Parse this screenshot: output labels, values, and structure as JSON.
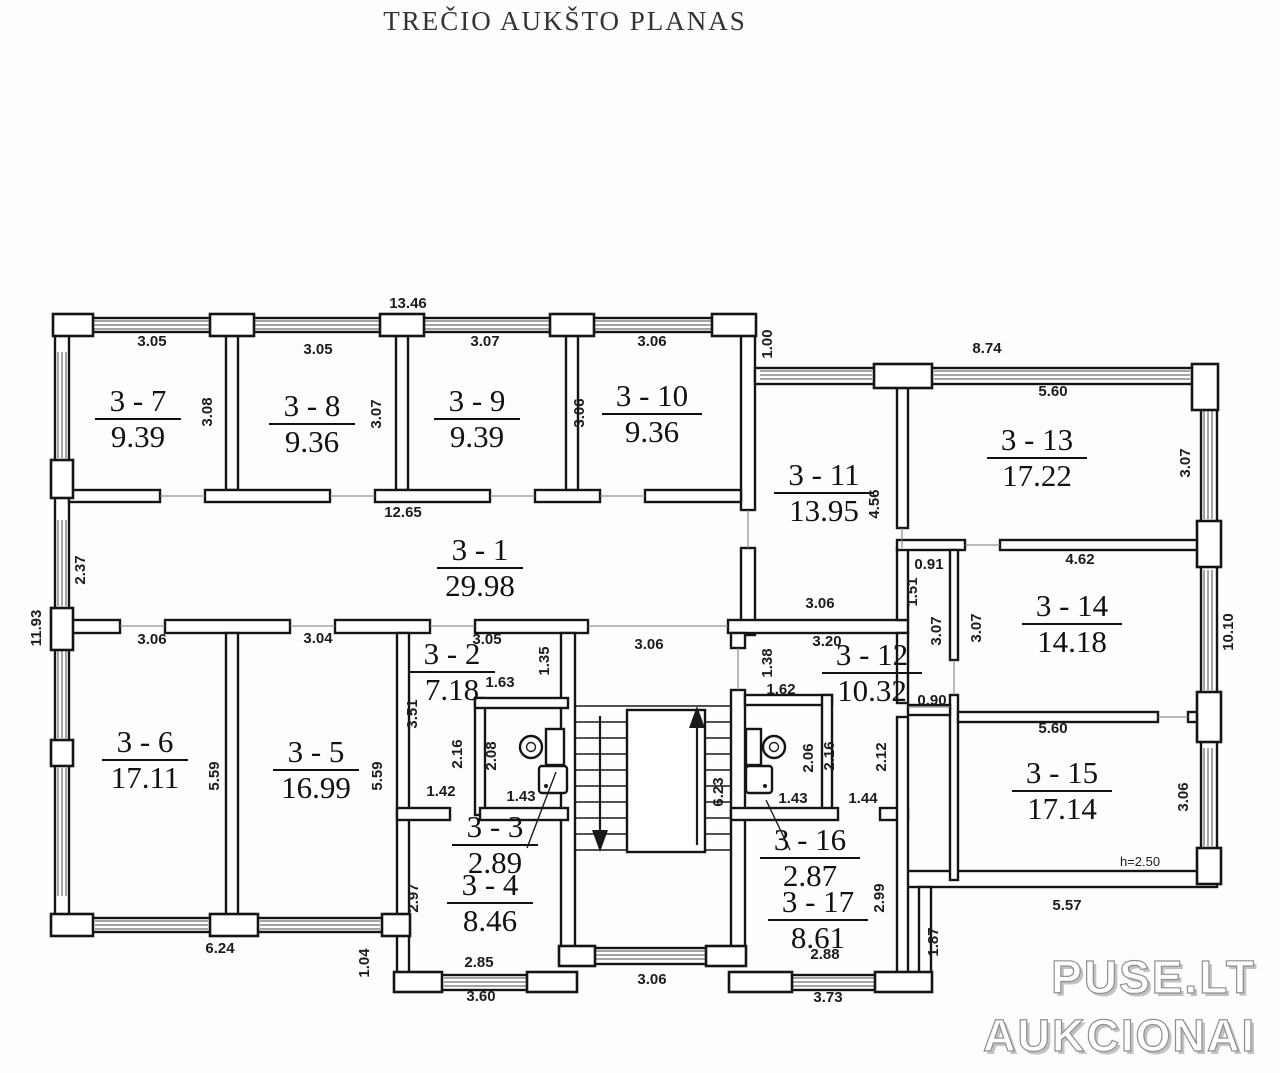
{
  "title": "TREČIO AUKŠTO PLANAS",
  "watermark": {
    "line1": "PUSE.LT",
    "line2": "AUKCIONAI"
  },
  "rooms": [
    {
      "id": "3 - 7",
      "area": "9.39",
      "x": 138,
      "y": 419
    },
    {
      "id": "3 - 8",
      "area": "9.36",
      "x": 312,
      "y": 424
    },
    {
      "id": "3 - 9",
      "area": "9.39",
      "x": 477,
      "y": 419
    },
    {
      "id": "3 - 10",
      "area": "9.36",
      "x": 652,
      "y": 414
    },
    {
      "id": "3 - 1",
      "area": "29.98",
      "x": 480,
      "y": 568
    },
    {
      "id": "3 - 2",
      "area": "7.18",
      "x": 452,
      "y": 672
    },
    {
      "id": "3 - 3",
      "area": "2.89",
      "x": 495,
      "y": 845
    },
    {
      "id": "3 - 4",
      "area": "8.46",
      "x": 490,
      "y": 903
    },
    {
      "id": "3 - 5",
      "area": "16.99",
      "x": 316,
      "y": 770
    },
    {
      "id": "3 - 6",
      "area": "17.11",
      "x": 145,
      "y": 760
    },
    {
      "id": "3 - 11",
      "area": "13.95",
      "x": 824,
      "y": 493
    },
    {
      "id": "3 - 12",
      "area": "10.32",
      "x": 872,
      "y": 673
    },
    {
      "id": "3 - 13",
      "area": "17.22",
      "x": 1037,
      "y": 458
    },
    {
      "id": "3 - 14",
      "area": "14.18",
      "x": 1072,
      "y": 624
    },
    {
      "id": "3 - 15",
      "area": "17.14",
      "x": 1062,
      "y": 791
    },
    {
      "id": "3 - 16",
      "area": "2.87",
      "x": 810,
      "y": 858
    },
    {
      "id": "3 - 17",
      "area": "8.61",
      "x": 818,
      "y": 920
    }
  ],
  "dims": [
    {
      "t": "13.46",
      "x": 408,
      "y": 308
    },
    {
      "t": "3.05",
      "x": 152,
      "y": 346
    },
    {
      "t": "3.05",
      "x": 318,
      "y": 354
    },
    {
      "t": "3.07",
      "x": 485,
      "y": 346
    },
    {
      "t": "3.06",
      "x": 652,
      "y": 346
    },
    {
      "t": "1.00",
      "x": 772,
      "y": 344,
      "v": 1
    },
    {
      "t": "8.74",
      "x": 987,
      "y": 353
    },
    {
      "t": "5.60",
      "x": 1053,
      "y": 396
    },
    {
      "t": "3.08",
      "x": 212,
      "y": 412,
      "v": 1
    },
    {
      "t": "3.07",
      "x": 381,
      "y": 414,
      "v": 1
    },
    {
      "t": "3.06",
      "x": 584,
      "y": 413,
      "v": 1
    },
    {
      "t": "3.07",
      "x": 1190,
      "y": 463,
      "v": 1
    },
    {
      "t": "12.65",
      "x": 403,
      "y": 517
    },
    {
      "t": "2.37",
      "x": 85,
      "y": 570,
      "v": 1
    },
    {
      "t": "11.93",
      "x": 41,
      "y": 628,
      "v": 1
    },
    {
      "t": "4.56",
      "x": 879,
      "y": 504,
      "v": 1
    },
    {
      "t": "3.06",
      "x": 820,
      "y": 608
    },
    {
      "t": "0.91",
      "x": 929,
      "y": 569
    },
    {
      "t": "1.51",
      "x": 917,
      "y": 592,
      "v": 1
    },
    {
      "t": "4.62",
      "x": 1080,
      "y": 564
    },
    {
      "t": "3.07",
      "x": 941,
      "y": 631,
      "v": 1
    },
    {
      "t": "3.07",
      "x": 981,
      "y": 628,
      "v": 1
    },
    {
      "t": "10.10",
      "x": 1233,
      "y": 632,
      "v": 1
    },
    {
      "t": "3.06",
      "x": 152,
      "y": 644
    },
    {
      "t": "3.04",
      "x": 318,
      "y": 643
    },
    {
      "t": "3.05",
      "x": 487,
      "y": 644
    },
    {
      "t": "1.35",
      "x": 549,
      "y": 661,
      "v": 1
    },
    {
      "t": "1.63",
      "x": 500,
      "y": 687
    },
    {
      "t": "3.06",
      "x": 649,
      "y": 649
    },
    {
      "t": "3.20",
      "x": 827,
      "y": 646
    },
    {
      "t": "1.38",
      "x": 772,
      "y": 663,
      "v": 1
    },
    {
      "t": "1.62",
      "x": 781,
      "y": 694
    },
    {
      "t": "0.90",
      "x": 932,
      "y": 705
    },
    {
      "t": "5.60",
      "x": 1053,
      "y": 733
    },
    {
      "t": "3.51",
      "x": 417,
      "y": 714,
      "v": 1
    },
    {
      "t": "2.16",
      "x": 462,
      "y": 754,
      "v": 1
    },
    {
      "t": "2.08",
      "x": 496,
      "y": 756,
      "v": 1
    },
    {
      "t": "5.59",
      "x": 219,
      "y": 776,
      "v": 1
    },
    {
      "t": "5.59",
      "x": 382,
      "y": 776,
      "v": 1
    },
    {
      "t": "6.23",
      "x": 723,
      "y": 792,
      "v": 1
    },
    {
      "t": "2.06",
      "x": 813,
      "y": 758,
      "v": 1
    },
    {
      "t": "2.16",
      "x": 834,
      "y": 756,
      "v": 1
    },
    {
      "t": "2.12",
      "x": 886,
      "y": 757,
      "v": 1
    },
    {
      "t": "3.06",
      "x": 1188,
      "y": 797,
      "v": 1
    },
    {
      "t": "1.42",
      "x": 441,
      "y": 796
    },
    {
      "t": "1.43",
      "x": 521,
      "y": 801
    },
    {
      "t": "1.43",
      "x": 793,
      "y": 803
    },
    {
      "t": "1.44",
      "x": 863,
      "y": 803
    },
    {
      "t": "2.97",
      "x": 418,
      "y": 898,
      "v": 1
    },
    {
      "t": "2.99",
      "x": 884,
      "y": 898,
      "v": 1
    },
    {
      "t": "h=2.50",
      "x": 1140,
      "y": 866,
      "s": 1
    },
    {
      "t": "1.87",
      "x": 938,
      "y": 942,
      "v": 1
    },
    {
      "t": "2.85",
      "x": 479,
      "y": 967
    },
    {
      "t": "6.24",
      "x": 220,
      "y": 953
    },
    {
      "t": "1.04",
      "x": 369,
      "y": 963,
      "v": 1
    },
    {
      "t": "2.88",
      "x": 825,
      "y": 959
    },
    {
      "t": "5.57",
      "x": 1067,
      "y": 910
    },
    {
      "t": "3.60",
      "x": 481,
      "y": 1001
    },
    {
      "t": "3.06",
      "x": 652,
      "y": 984
    },
    {
      "t": "3.73",
      "x": 828,
      "y": 1002
    }
  ]
}
